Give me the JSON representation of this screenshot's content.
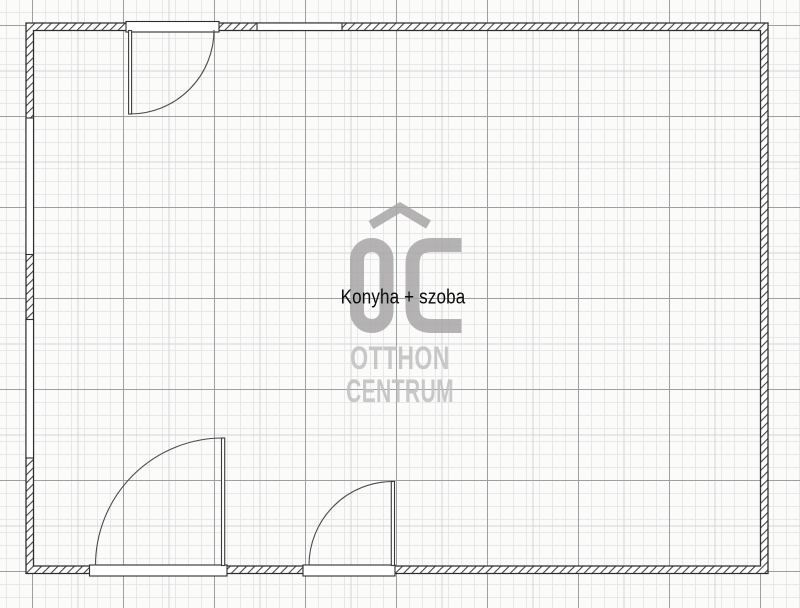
{
  "room": {
    "label": "Konyha + szoba"
  },
  "watermark": {
    "initials": "OC",
    "name_line1": "OTTHON",
    "name_line2": "CENTRUM"
  },
  "colors": {
    "background": "#fbfbfa",
    "grid_fine": "#e7e8ea",
    "grid_medium": "#d3d4d6",
    "grid_major": "#9da0a3",
    "wall_line": "#2e2e2e",
    "wall_hatch": "#3f3f3f",
    "door_line": "#4a4a4a",
    "watermark_gray": "#a8a6a6",
    "watermark_text_gray": "#c1bfbf",
    "label_text": "#0a0a0a"
  }
}
